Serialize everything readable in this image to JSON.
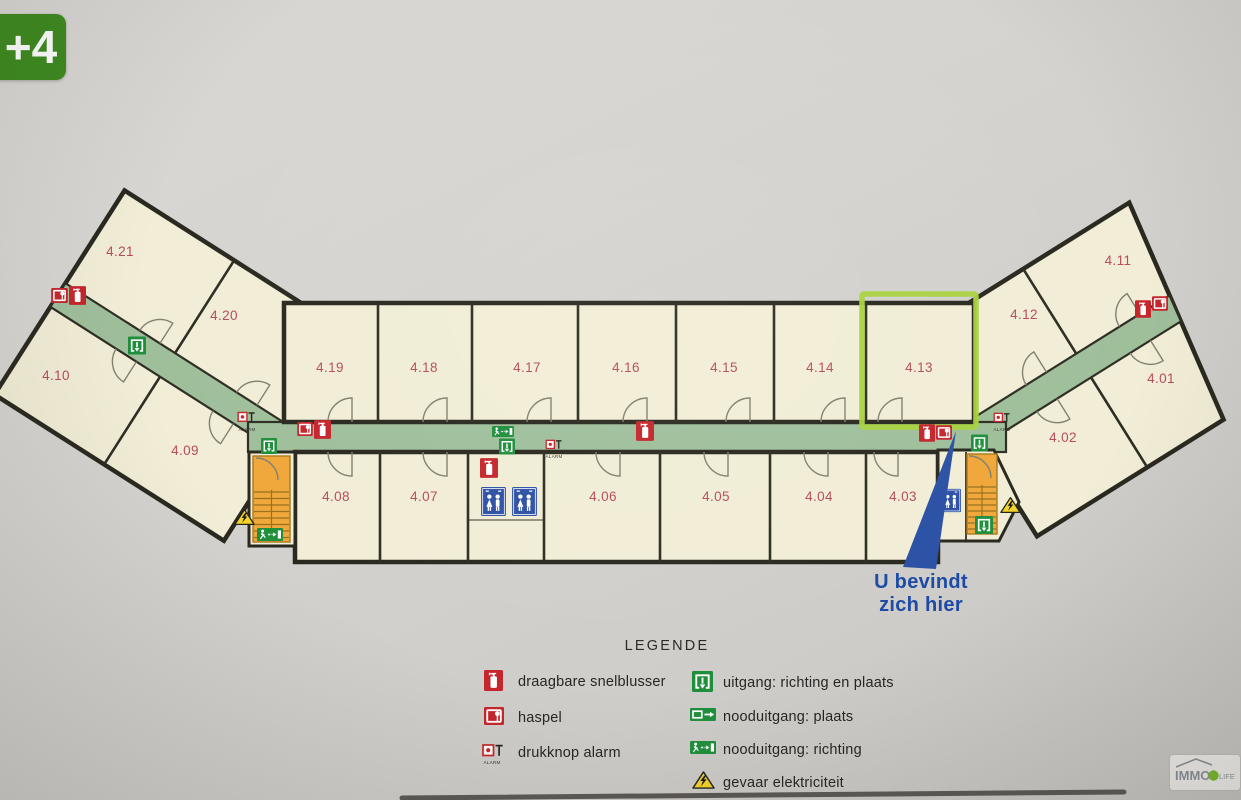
{
  "floor_badge": "+4",
  "you_are_here": {
    "line1": "U bevindt",
    "line2": "zich hier"
  },
  "alarm_caption": "ALARM",
  "highlighted_room": "4.13",
  "legend": {
    "title": "LEGENDE",
    "items_left": [
      {
        "icon": "fire-extinguisher-icon",
        "label": "draagbare snelblusser"
      },
      {
        "icon": "hose-reel-icon",
        "label": "haspel"
      },
      {
        "icon": "alarm-button-icon",
        "label": "drukknop alarm"
      }
    ],
    "items_right": [
      {
        "icon": "exit-direction-place-icon",
        "label": "uitgang: richting en plaats"
      },
      {
        "icon": "emergency-exit-place-icon",
        "label": "nooduitgang: plaats"
      },
      {
        "icon": "emergency-exit-direction-icon",
        "label": "nooduitgang: richting"
      },
      {
        "icon": "electricity-danger-icon",
        "label": "gevaar elektriciteit"
      }
    ]
  },
  "rooms": {
    "r401": "4.01",
    "r402": "4.02",
    "r403": "4.03",
    "r404": "4.04",
    "r405": "4.05",
    "r406": "4.06",
    "r407": "4.07",
    "r408": "4.08",
    "r409": "4.09",
    "r410": "4.10",
    "r411": "4.11",
    "r412": "4.12",
    "r413": "4.13",
    "r414": "4.14",
    "r415": "4.15",
    "r416": "4.16",
    "r417": "4.17",
    "r418": "4.18",
    "r419": "4.19",
    "r420": "4.20",
    "r421": "4.21"
  },
  "colors": {
    "corridor_green": "#9fbf9b",
    "room_cream": "#f1edd6",
    "highlight_lime": "#a8d23e",
    "exit_green": "#1f8f3c",
    "safety_red": "#c5262c",
    "stairs_orange": "#f0a73b",
    "marker_blue": "#2b51a5"
  },
  "logo": {
    "word1": "IMMO",
    "word2": "LIFE"
  }
}
